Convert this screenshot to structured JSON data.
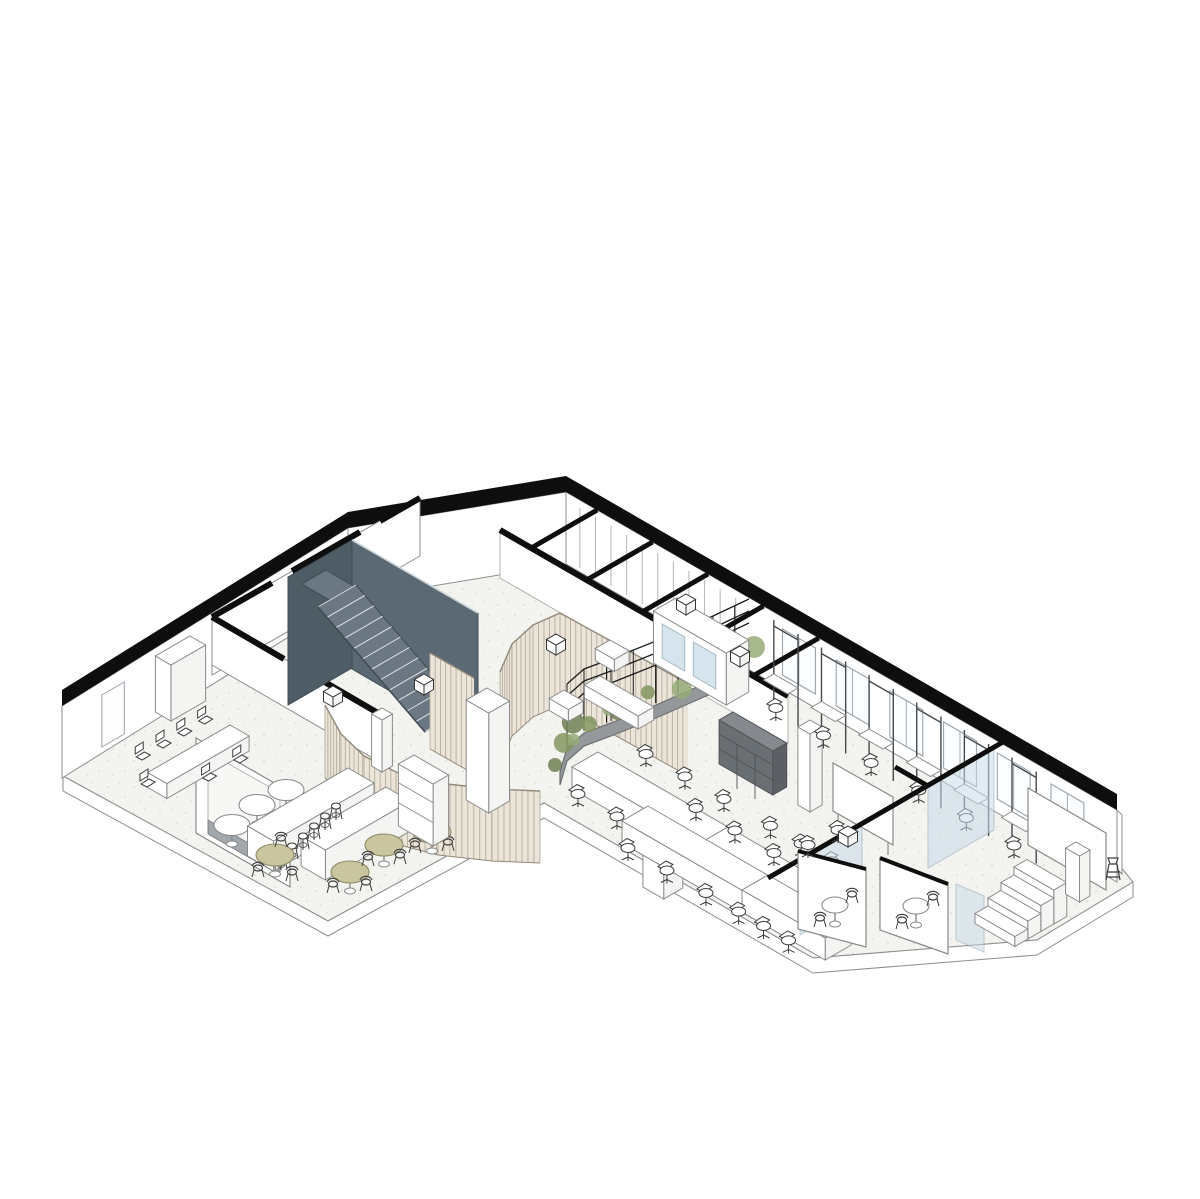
{
  "artwork": {
    "kind": "axonometric cutaway floor plan of a single office storey",
    "paper_color": "#ffffff"
  },
  "palette": {
    "paper": "#ffffff",
    "cut_wall": "#0e0e0e",
    "wall_fill": "#ffffff",
    "wall_line": "#8e8e8e",
    "line_light": "#b5b5b1",
    "floor_fill": "#f3f3f0",
    "floor_speckle": "#d7d7d1",
    "stair_wall": "#5b6974",
    "stair_side": "#4e5c66",
    "stair_tread": "#6b7883",
    "tread_line": "#dfe3e6",
    "slat_fill": "#ebe4d8",
    "slat_line": "#b6ad9e",
    "slat_edge": "#93897a",
    "plant_dark": "#6e8052",
    "plant_mid": "#82955f",
    "plant_light": "#97ac78",
    "planter_base": "#95989a",
    "planter_edge": "#6c6f71",
    "glass_fill": "#c8dbe8",
    "glass_edge": "#87a0b0",
    "table_khaki": "#c9c59e",
    "khaki_edge": "#8e8a67",
    "bench_gray": "#a2a7ab",
    "shelf_top": "#85888c",
    "shelf_front": "#6a6f73",
    "shelf_side": "#5c6064",
    "chair_line": "#3c3c3c",
    "furniture_line": "#8a8a8a",
    "trellis_line": "#1d1d1d"
  },
  "scene": {
    "zones": [
      {
        "name": "meeting-room-left",
        "furniture": {
          "conference_table": 1,
          "side_chairs": 7,
          "cabinet": 1
        }
      },
      {
        "name": "cafe",
        "furniture": {
          "banquette_frame": 1,
          "bistro_tables": 3,
          "kitchen_islands": 2,
          "bar_stools": 6,
          "cafe_tables": 4,
          "wire_chairs": 9,
          "bookshelf": 1,
          "curved_slat_screen": 1
        }
      },
      {
        "name": "stairwell",
        "furniture": {
          "flights": 1,
          "treads": 13
        }
      },
      {
        "name": "wc-block",
        "furniture": {
          "stall_partitions": 5
        }
      },
      {
        "name": "lounge",
        "furniture": {
          "sofa": 1,
          "armchairs": 2,
          "curved_planter": 1,
          "trellis_rails": 3,
          "tall_slat_curtain": 1
        }
      },
      {
        "name": "open-office",
        "furniture": {
          "desks": 4,
          "task_chairs": 24,
          "storage_cubby": 1,
          "mobile_whiteboard": 1,
          "columns": 3,
          "focus_booths": 6,
          "windows": 6,
          "glass_phone_booths": 2
        }
      },
      {
        "name": "glass-meeting-rooms",
        "furniture": {
          "glass_panels": 3,
          "pivot_panels": 2,
          "round_tables": 2,
          "wire_chairs": 4,
          "task_chairs": 2
        }
      },
      {
        "name": "workshop-room",
        "furniture": {
          "wall_whiteboard": 1,
          "cabinet": 1,
          "stool": 1,
          "tiered_steps": 4
        }
      }
    ],
    "counts": {
      "stair_treads": 13,
      "wc_partitions": 5,
      "focus_booths": 6,
      "windows": 6,
      "plants": 12,
      "tier_steps": 4,
      "bar_stools": 6,
      "bistro_tables": 3,
      "cafe_tables": 4,
      "desk_chairs_per_side": 3,
      "trellis_rails": 3,
      "conference_side_chairs": 7,
      "facade_openings": 3,
      "wall_panel_lines": 11,
      "glass_door_panes": 2
    }
  }
}
